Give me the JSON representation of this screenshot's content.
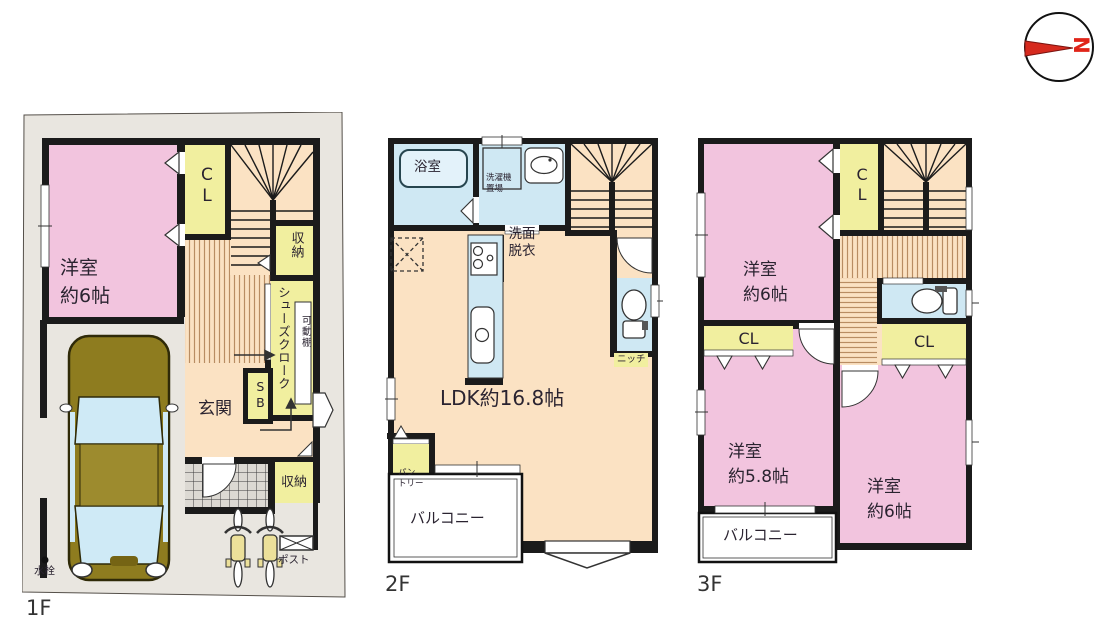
{
  "compass": {
    "north": "N"
  },
  "floor1": {
    "label": "1F",
    "bedroom": {
      "line1": "洋室",
      "line2": "約6帖"
    },
    "closet": "CL",
    "storage_upper": "収納",
    "shoe_closet": "シューズクローク",
    "movable_shelf": "可動棚",
    "shoe_box": "SB",
    "entrance": "玄関",
    "storage_lower": "収納",
    "post": "ポスト",
    "faucet": "水栓"
  },
  "floor2": {
    "label": "2F",
    "bath": "浴室",
    "washer": {
      "line1": "洗濯機",
      "line2": "置場"
    },
    "washroom": {
      "line1": "洗面",
      "line2": "脱衣"
    },
    "ldk": "LDK約16.8帖",
    "niche": "ニッチ",
    "pantry": {
      "line1": "パン",
      "line2": "トリー"
    },
    "balcony": "バルコニー"
  },
  "floor3": {
    "label": "3F",
    "bedroom_a": {
      "line1": "洋室",
      "line2": "約6帖"
    },
    "closet_top": "CL",
    "closet_left": "CL",
    "closet_right": "CL",
    "bedroom_b": {
      "line1": "洋室",
      "line2": "約5.8帖"
    },
    "bedroom_c": {
      "line1": "洋室",
      "line2": "約6帖"
    },
    "balcony": "バルコニー"
  },
  "colors": {
    "wall": "#1b1b1b",
    "room_pink": "#f2c4de",
    "closet_yellow": "#f1ef9f",
    "floor_peach": "#fbe2c3",
    "wet_blue": "#cfe8f3",
    "site_gray": "#e9e6e0",
    "balcony_white": "#ffffff",
    "compass_red": "#d62a1e"
  }
}
